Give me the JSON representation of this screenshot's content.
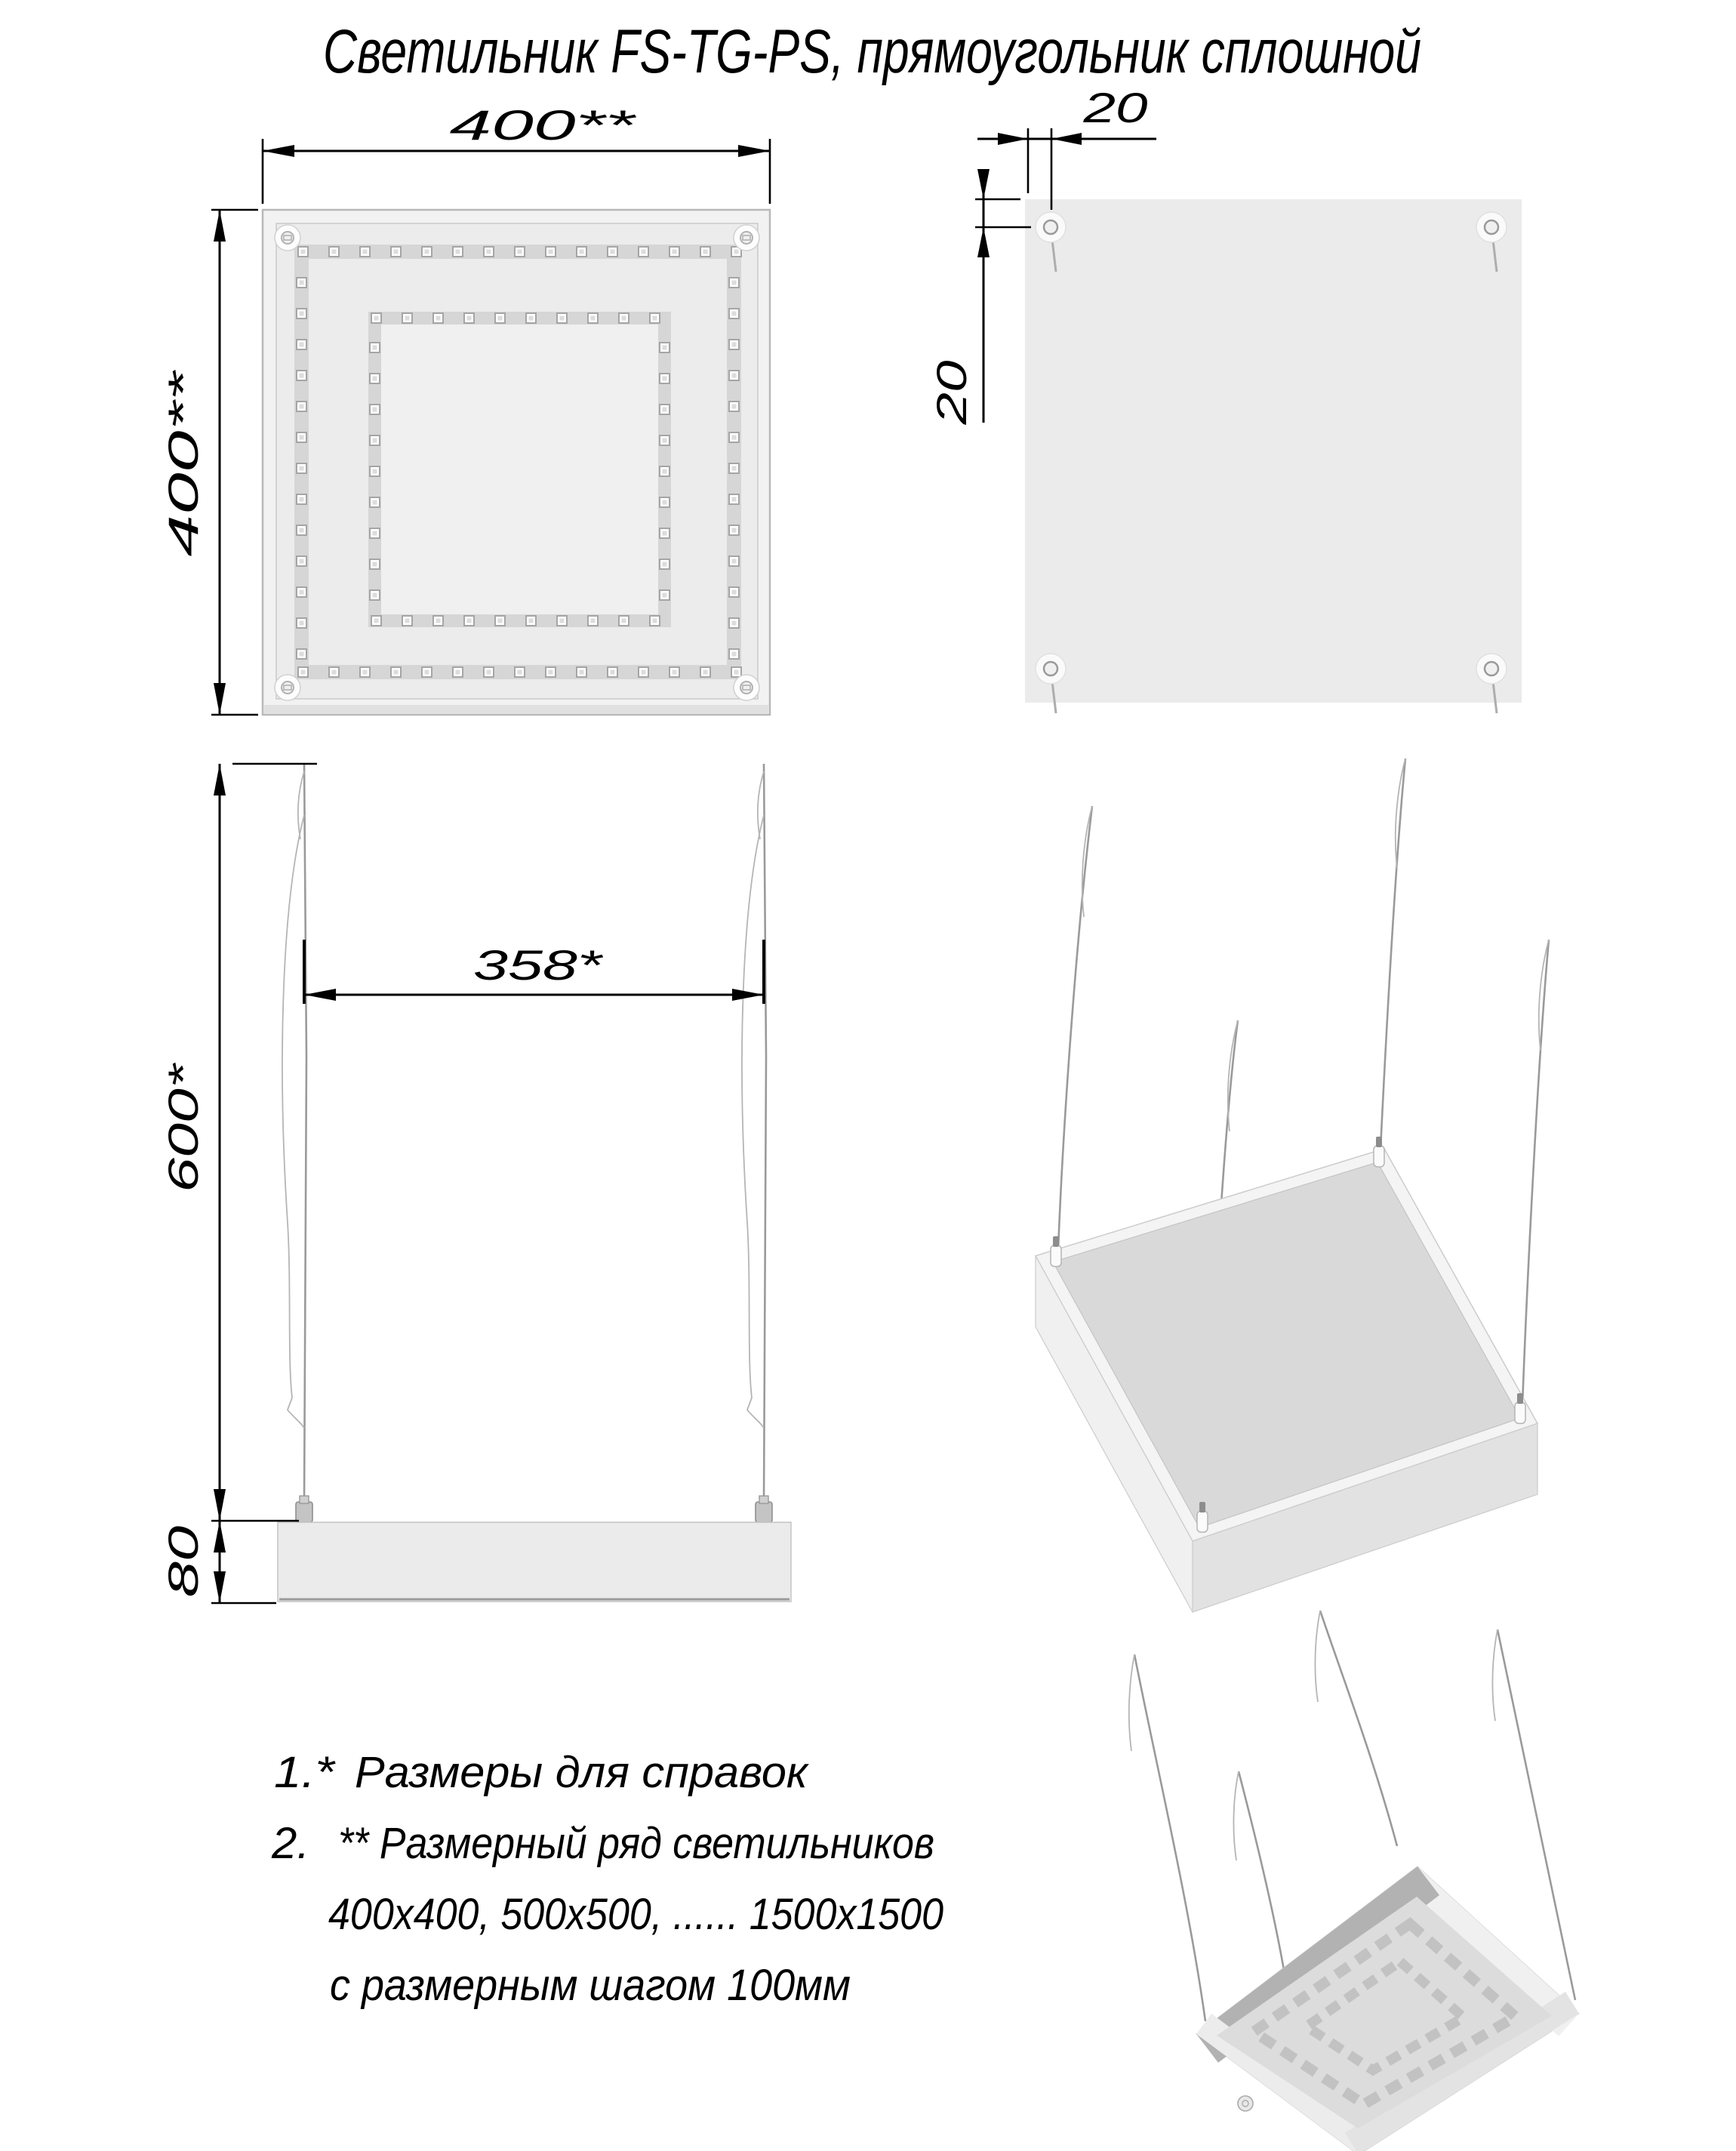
{
  "title": "Светильник FS-TG-PS, прямоугольник сплошной",
  "dimensions": {
    "front_width": "400**",
    "front_height": "400**",
    "hole_offset_top": "20",
    "hole_offset_side": "20",
    "cable_spacing": "358*",
    "suspension_length": "600*",
    "body_height": "80"
  },
  "notes": [
    {
      "marker": "1.*",
      "text": "Размеры для справок"
    },
    {
      "marker": "2.",
      "text": "** Размерный ряд светильников"
    },
    {
      "marker": "",
      "text": "400х400, 500х500, ...... 1500х1500"
    },
    {
      "marker": "",
      "text": "с размерным шагом 100мм"
    }
  ]
}
